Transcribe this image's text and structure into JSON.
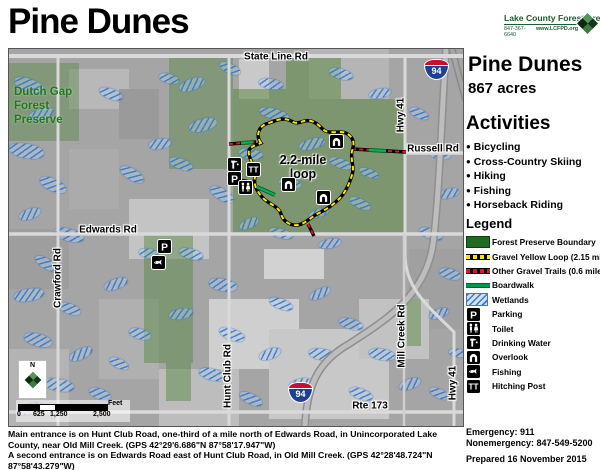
{
  "header": {
    "title": "Pine Dunes",
    "org": "Lake County Forest Preserves",
    "phone": "847-367-6640",
    "web": "www.LCFPD.org"
  },
  "sidebar": {
    "name": "Pine Dunes",
    "acres": "867 acres",
    "activities_title": "Activities",
    "activities": [
      "Bicycling",
      "Cross-Country Skiing",
      "Hiking",
      "Fishing",
      "Horseback Riding"
    ],
    "legend_title": "Legend",
    "legend": [
      {
        "label": "Forest Preserve Boundary"
      },
      {
        "label": "Gravel Yellow Loop (2.15 miles)"
      },
      {
        "label": "Other Gravel Trails (0.6 miles)"
      },
      {
        "label": "Boardwalk"
      },
      {
        "label": "Wetlands"
      },
      {
        "label": "Parking"
      },
      {
        "label": "Toilet"
      },
      {
        "label": "Drinking Water"
      },
      {
        "label": "Overlook"
      },
      {
        "label": "Fishing"
      },
      {
        "label": "Hitching Post"
      }
    ]
  },
  "map": {
    "labels": {
      "state_line": "State Line Rd",
      "russell": "Russell Rd",
      "edwards": "Edwards Rd",
      "rte173": "Rte 173",
      "crawford": "Crawford Rd",
      "hunt_club": "Hunt Club Rd",
      "mill_creek": "Mill Creek Rd",
      "hwy41_top": "Hwy 41",
      "hwy41_bottom": "Hwy 41",
      "dutch_gap": "Dutch Gap Forest Preserve",
      "loop_line1": "2.2-mile",
      "loop_line2": "loop",
      "interstate": "94",
      "compass_n": "N"
    },
    "scalebar": {
      "t0": "0",
      "t625": "625",
      "t1250": "1,250",
      "t2500": "2,500",
      "unit": "Feet"
    }
  },
  "footer": {
    "line1": "Main entrance is on Hunt Club Road, one-third of a mile north of Edwards Road, in Unincorporated Lake County, near Old Mill Creek.   (GPS 42°29'6.686\"N 87°58'17.947\"W)",
    "line2": "A second entrance is on Edwards Road east of Hunt Club Road, in Old Mill Creek. (GPS 42°28'48.724\"N  87°58'43.279\"W)",
    "emergency": "Emergency: 911",
    "nonemergency": "Nonemergency: 847-549-5200",
    "prepared": "Prepared 16 November 2015"
  }
}
